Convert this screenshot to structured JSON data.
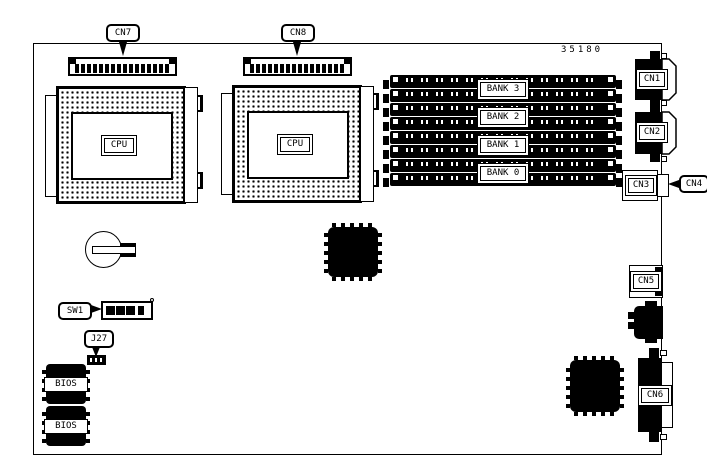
{
  "diagram": {
    "board_number": "35180",
    "callouts": {
      "cn7": "CN7",
      "cn8": "CN8",
      "sw1": "SW1",
      "j27": "J27",
      "cn4": "CN4"
    },
    "components": {
      "cpu_left": "CPU",
      "cpu_right": "CPU",
      "cn1": "CN1",
      "cn2": "CN2",
      "cn3": "CN3",
      "cn5": "CN5",
      "cn6": "CN6",
      "bios_top": "BIOS",
      "bios_bottom": "BIOS"
    },
    "memory_banks": [
      {
        "label": "BANK 3"
      },
      {
        "label": "BANK 2"
      },
      {
        "label": "BANK 1"
      },
      {
        "label": "BANK 0"
      }
    ],
    "colors": {
      "line": "#000000",
      "background": "#ffffff"
    }
  }
}
